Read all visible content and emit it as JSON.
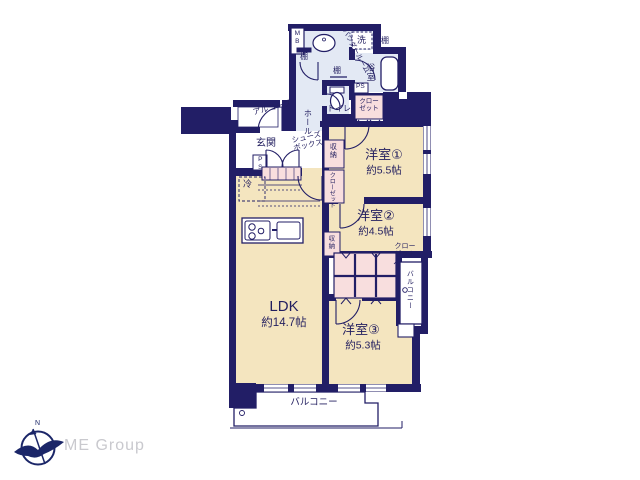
{
  "colors": {
    "wall": "#221e66",
    "room_fill": "#f4e5bf",
    "wet_area_fill": "#e3e9f4",
    "closet_fill": "#f8dede",
    "text": "#221e5f",
    "logo_mark": "#1b2668",
    "logo_text": "#c9c9ce"
  },
  "plan": {
    "rooms": {
      "ldk": {
        "name": "LDK",
        "area": "約14.7帖"
      },
      "room1": {
        "name": "洋室①",
        "area": "約5.5帖"
      },
      "room2": {
        "name": "洋室②",
        "area": "約4.5帖"
      },
      "room3": {
        "name": "洋室③",
        "area": "約5.3帖"
      }
    },
    "labels": {
      "mb": "MB",
      "powder_room": "パウダールーム",
      "laundry": "洗",
      "shelf_a": "棚",
      "shelf_b": "棚",
      "shelf_c": "棚",
      "bathroom": "浴室",
      "ps_bath": "PS",
      "toilet": "トイレ",
      "closet_bath": "クローゼット",
      "alcove": "アルコーブ",
      "hall": "ホール",
      "entrance": "玄関",
      "shoe_box": "シューズボックス",
      "ps_entrance": "PS",
      "fridge": "冷",
      "storage_room1": "収納",
      "closet_room1": "クローゼット",
      "storage_room2": "収納",
      "closet_room2": "クローゼット",
      "balcony_right": "バルコニー",
      "balcony_bottom": "バルコニー"
    }
  },
  "logo": {
    "company": "ME Group",
    "compass": "N"
  }
}
